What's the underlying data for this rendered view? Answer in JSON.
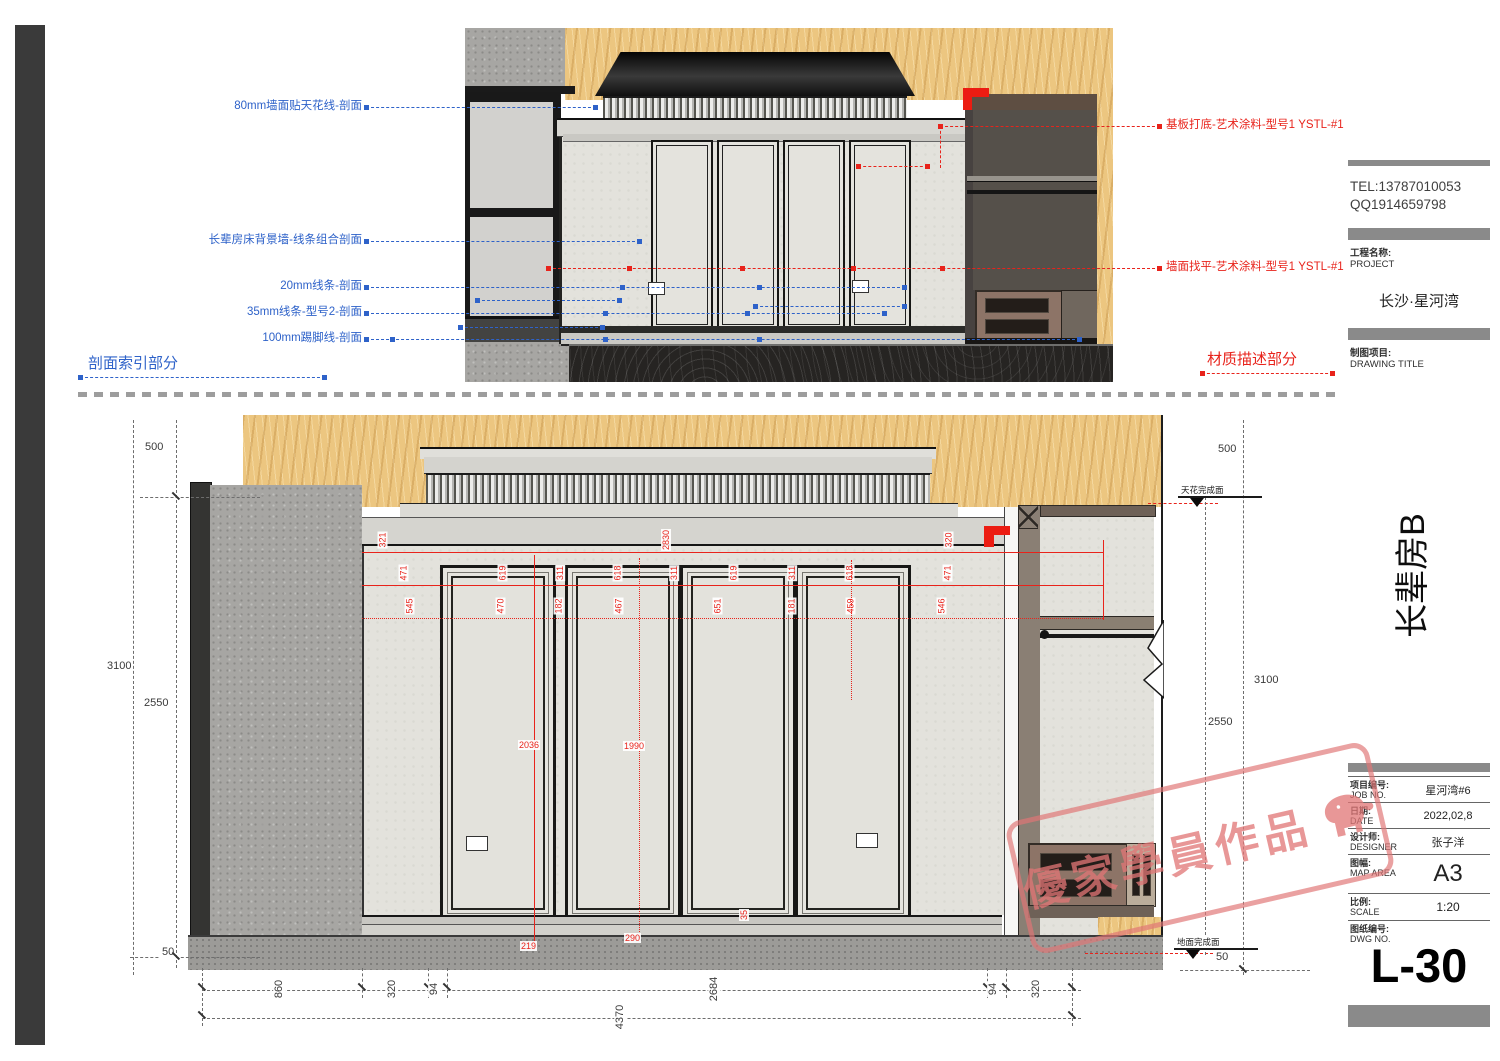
{
  "page": {
    "section_index_title": "剖面索引部分",
    "material_desc_title": "材质描述部分"
  },
  "section_annotations": {
    "items": [
      "80mm墙面贴天花线-剖面",
      "长辈房床背景墙-线条组合剖面",
      "20mm线条-剖面",
      "35mm线条-型号2-剖面",
      "100mm踢脚线-剖面"
    ]
  },
  "material_annotations": {
    "items": [
      "基板打底-艺术涂料-型号1 YSTL-#1",
      "墙面找平-艺术涂料-型号1 YSTL-#1"
    ]
  },
  "levels": {
    "ceiling": "天花完成面",
    "floor": "地面完成面"
  },
  "dims": {
    "left": {
      "a": "500",
      "b": "3100",
      "c": "2550",
      "d": "50"
    },
    "right": {
      "a": "500",
      "b": "3100",
      "c": "2550",
      "d": "50"
    },
    "bottom": {
      "chain": [
        "860",
        "320",
        "94",
        "2684",
        "94",
        "320"
      ],
      "total": "4370"
    },
    "red": {
      "top": [
        "321",
        "2830",
        "320"
      ],
      "row1": [
        "471",
        "619",
        "311",
        "618",
        "311",
        "619",
        "311",
        "618",
        "471"
      ],
      "row2": [
        "545",
        "470",
        "182",
        "467",
        "651",
        "181",
        "459",
        "546"
      ],
      "vertical": [
        "2036",
        "1990"
      ],
      "bottom": [
        "219",
        "290",
        "35"
      ]
    }
  },
  "titleblock": {
    "tel": "TEL:13787010053",
    "qq": "QQ1914659798",
    "project_label": "工程名称:",
    "project_label_en": "PROJECT",
    "project_name": "长沙·星河湾",
    "drawing_label": "制图项目:",
    "drawing_label_en": "DRAWING TITLE",
    "drawing_title": "长辈房B",
    "rows": [
      {
        "label": "项目编号:",
        "label_en": "JOB NO.",
        "value": "星河湾#6"
      },
      {
        "label": "日期:",
        "label_en": "DATE",
        "value": "2022,02,8"
      },
      {
        "label": "设计师:",
        "label_en": "DESIGNER",
        "value": "张子洋"
      },
      {
        "label": "图幅:",
        "label_en": "MAP AREA",
        "value": "A3"
      },
      {
        "label": "比例:",
        "label_en": "SCALE",
        "value": "1:20"
      },
      {
        "label": "图纸编号:",
        "label_en": "DWG NO.",
        "value": ""
      }
    ],
    "sheet_no": "L-30"
  },
  "watermark": {
    "text": "優家學員作品"
  }
}
